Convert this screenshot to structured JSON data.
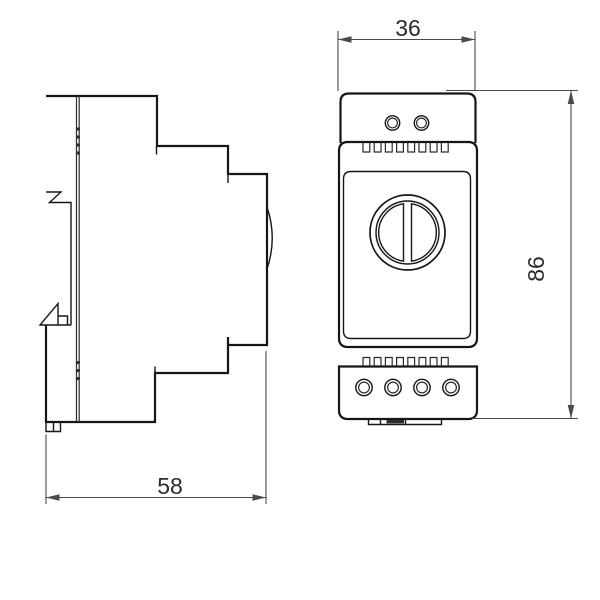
{
  "palette": {
    "bg": "#ffffff",
    "outline": "#161616",
    "detail": "#2b2b2b",
    "dim": "#4a4a4a",
    "label": "#2b2b2b"
  },
  "drawing": {
    "kind": "technical-dimension-drawing",
    "views": [
      "side-profile",
      "front"
    ],
    "dims": {
      "width": {
        "label": "36"
      },
      "height": {
        "label": "86"
      },
      "depth": {
        "label": "58"
      }
    }
  }
}
